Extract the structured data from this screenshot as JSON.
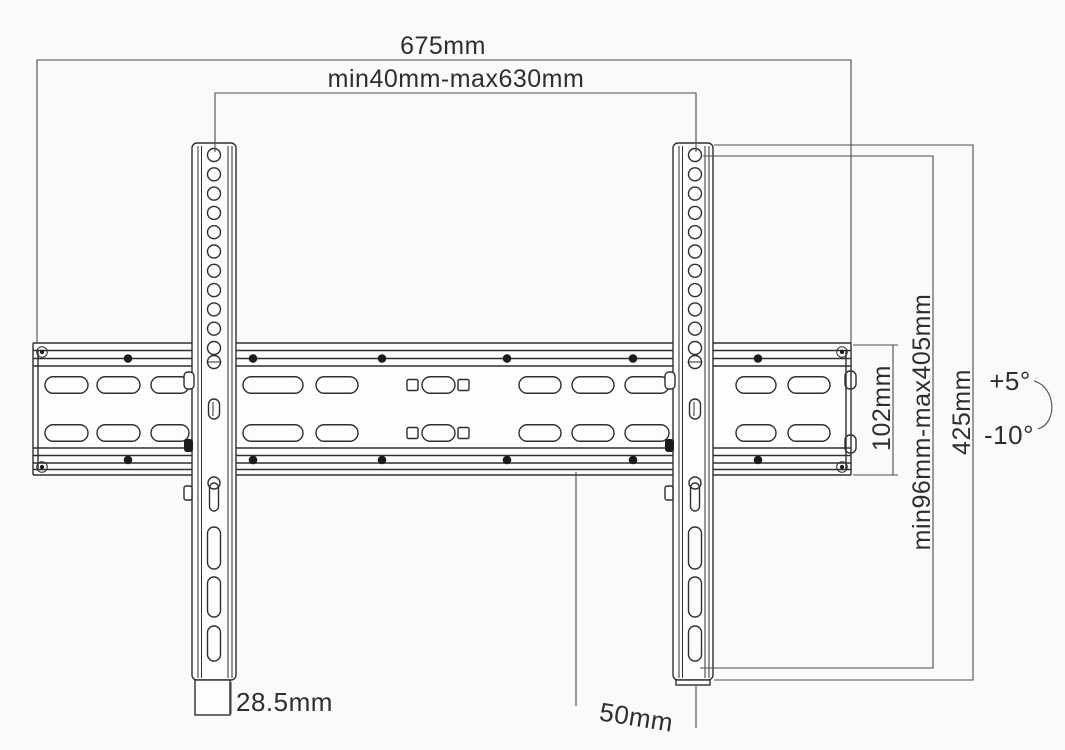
{
  "diagram": {
    "labels": {
      "total_width": "675mm",
      "horizontal_hole_range": "min40mm-max630mm",
      "wall_plate_height": "102mm",
      "vertical_hole_range": "min96mm-max405mm",
      "bracket_height": "425mm",
      "tilt_up": "+5°",
      "tilt_down": "-10°",
      "bracket_width": "28.5mm",
      "wall_clearance": "50mm"
    },
    "colors": {
      "background": "#fbfaf8",
      "drawing_line": "#2f2f2f",
      "dimension_line": "#4d4d4d",
      "text": "#2e2e2e"
    }
  }
}
